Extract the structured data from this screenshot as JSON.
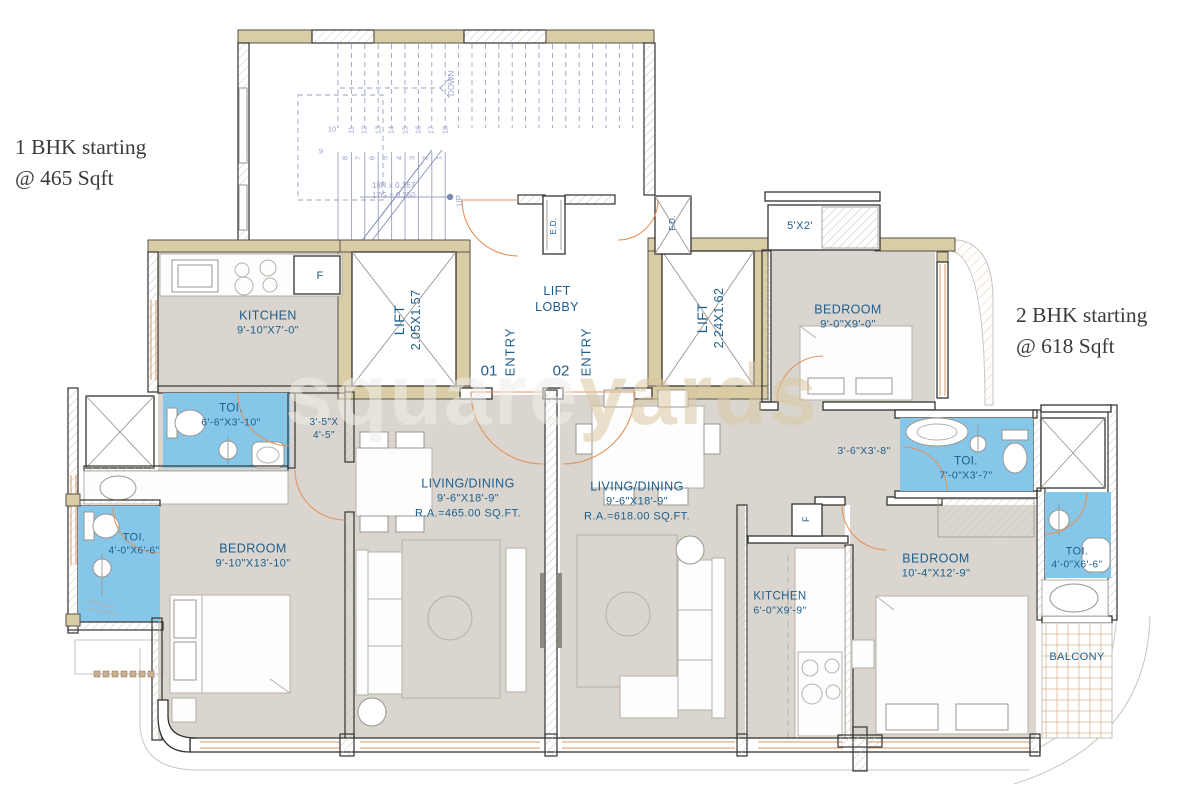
{
  "colors": {
    "label_blue": "#1c5e8e",
    "floor": "#dad6cf",
    "wall_tan": "#d9cda6",
    "toilet_blue": "#85c6e9",
    "door_orange": "#e2945f",
    "stair_blue": "#9aa2c6",
    "watermark_tan": "#d9c8a2"
  },
  "headlines": {
    "left": {
      "line1": "1 BHK starting",
      "line2": "@ 465 Sqft"
    },
    "right": {
      "line1": "2 BHK starting",
      "line2": "@ 618 Sqft"
    }
  },
  "watermark": {
    "word1": "square",
    "word2": "yards"
  },
  "stairs": {
    "down_label": "DOWN",
    "up_label": "UP",
    "note1": "18R x 0.167",
    "note2": "17G x 0.250",
    "upper_numbers": [
      "11",
      "12",
      "13",
      "14",
      "15",
      "16",
      "17",
      "18"
    ],
    "lower_numbers": [
      "8",
      "7",
      "6",
      "5",
      "4",
      "3",
      "2",
      "1"
    ],
    "corner_numbers": [
      "10",
      "9"
    ]
  },
  "labels": {
    "kitchen1": {
      "name": "KITCHEN",
      "dims": "9'-10\"X7'-0\""
    },
    "fridge1": "F",
    "fridge2": "F",
    "lift1": {
      "name": "LIFT",
      "dims": "2.05X1.57"
    },
    "lift2": {
      "name": "LIFT",
      "dims": "2.24X1.62"
    },
    "lift_lobby": {
      "line1": "LIFT",
      "line2": "LOBBY"
    },
    "entry1": {
      "num": "01",
      "label": "ENTRY"
    },
    "entry2": {
      "num": "02",
      "label": "ENTRY"
    },
    "ed": "E.D.",
    "fd": "F.D.",
    "niche": "5'X2'",
    "bedroom_top_right": {
      "name": "BEDROOM",
      "dims": "9'-0\"X9'-0\""
    },
    "passage_right": "3'-6\"X3'-8\"",
    "toilet_right1": {
      "name": "TOI.",
      "dims": "7'-0\"X3'-7\""
    },
    "toilet_right2": {
      "name": "TOI.",
      "dims": "4'-0\"X6'-6\""
    },
    "balcony": "BALCONY",
    "bedroom_right": {
      "name": "BEDROOM",
      "dims": "10'-4\"X12'-9\""
    },
    "kitchen2": {
      "name": "KITCHEN",
      "dims": "6'-0\"X9'-9\""
    },
    "living1": {
      "name": "LIVING/DINING",
      "dims": "9'-6\"X18'-9\"",
      "area": "R.A.=465.00 SQ.FT."
    },
    "living2": {
      "name": "LIVING/DINING",
      "dims": "9'-6\"X18'-9\"",
      "area": "R.A.=618.00 SQ.FT."
    },
    "bedroom_left": {
      "name": "BEDROOM",
      "dims": "9'-10\"X13'-10\""
    },
    "toilet_left1": {
      "name": "TOI.",
      "dims": "6'-6\"X3'-10\""
    },
    "toilet_left2": {
      "name": "TOI.",
      "dims": "4'-0\"X6'-6\""
    },
    "passage_left": {
      "line1": "3'-5\"X",
      "line2": "4'-5\""
    }
  }
}
